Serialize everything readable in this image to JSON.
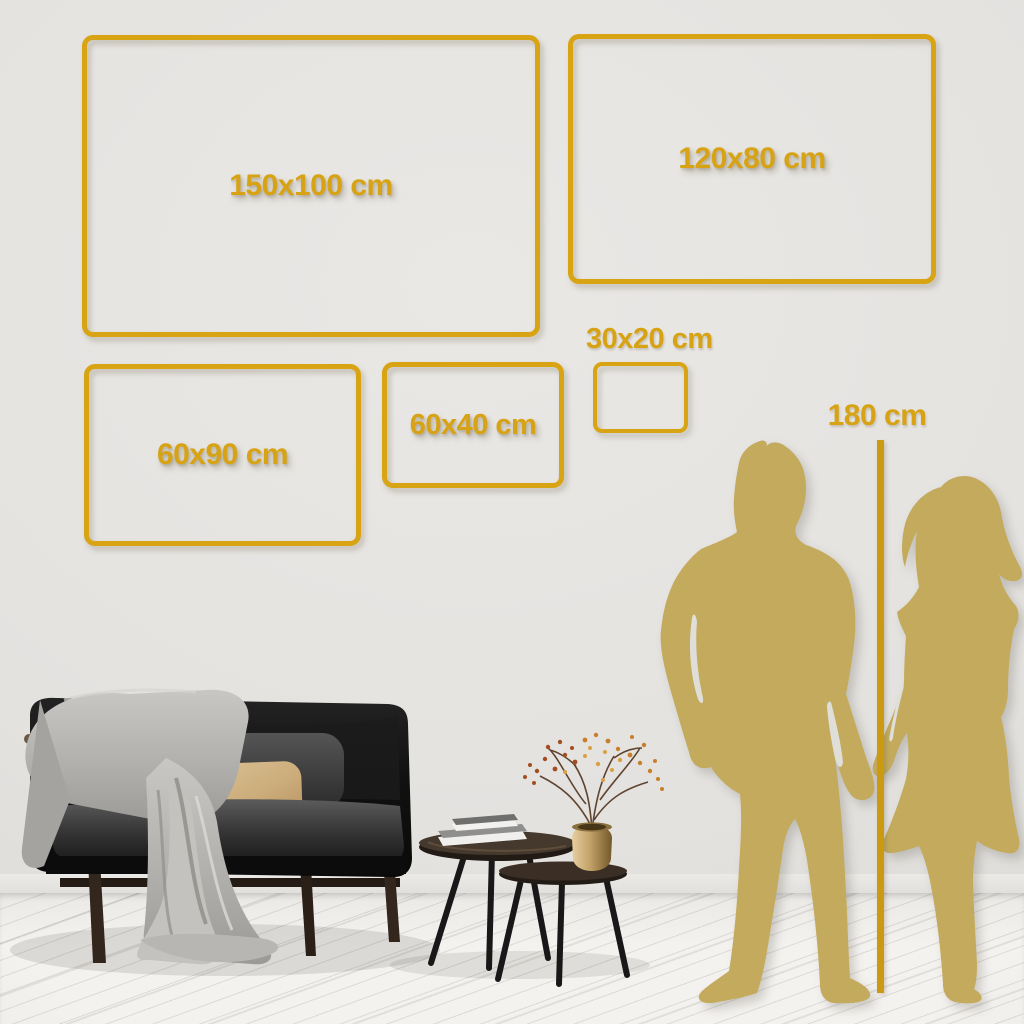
{
  "size_guide": {
    "frames": [
      {
        "label": "150x100 cm"
      },
      {
        "label": "120x80 cm"
      },
      {
        "label": "30x20 cm"
      },
      {
        "label": "60x40 cm"
      },
      {
        "label": "60x90 cm"
      }
    ],
    "height_marker_label": "180 cm"
  },
  "colors": {
    "frame_gold": "#D8A414",
    "label_gold": "#D7A315",
    "marker_line_gold": "#CC9A10",
    "silhouette_gold": "#C3AA5C",
    "wall": "#E4E2DF",
    "floor": "#F2F0ED"
  }
}
